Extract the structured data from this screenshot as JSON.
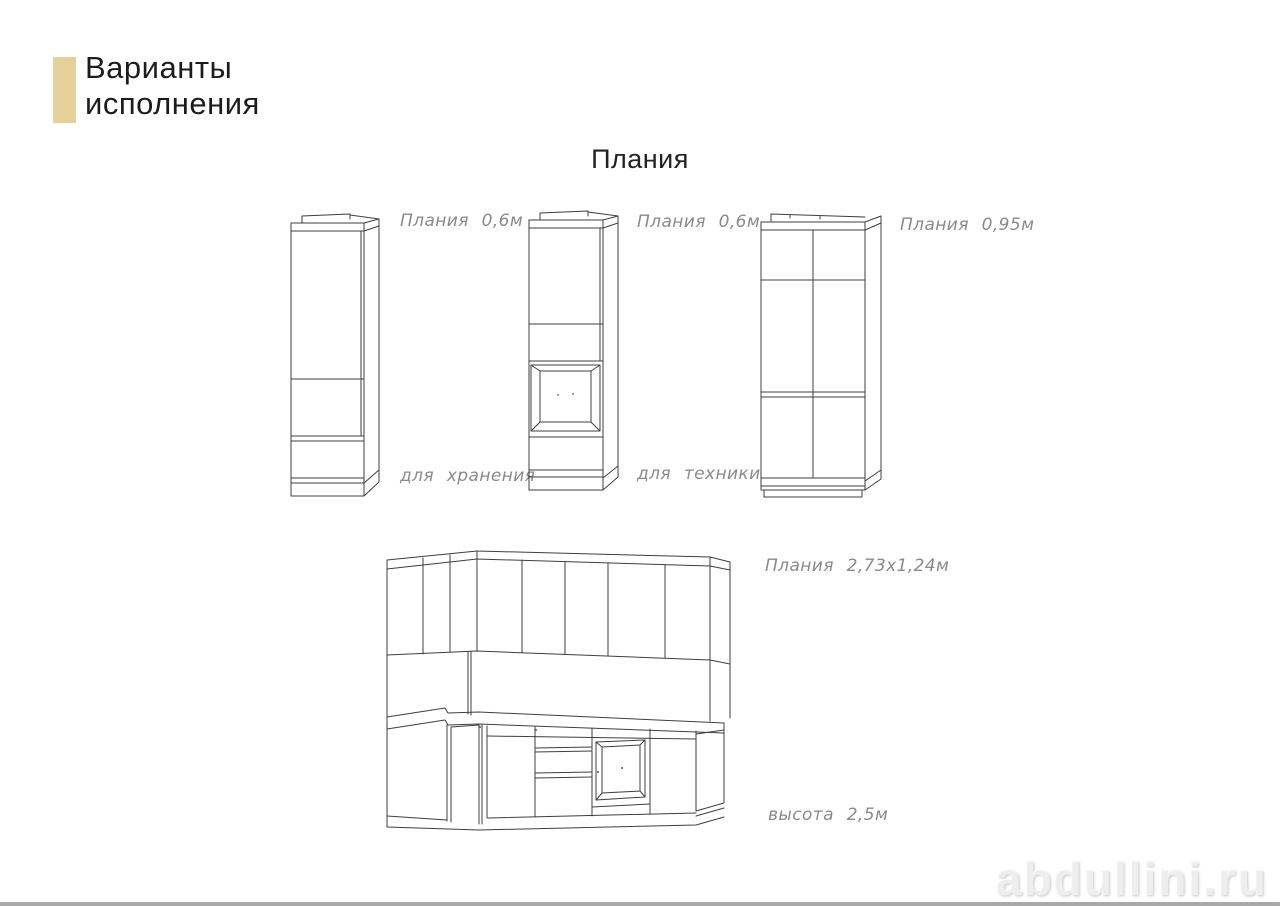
{
  "colors": {
    "accent_bar": "#e5d29a",
    "drawing_line": "#3f3f3f",
    "label_text": "#8a8a8a",
    "watermark": "#eeeeee",
    "bottom_bar": "#a9a9a9"
  },
  "header": {
    "title_line1": "Варианты",
    "title_line2": "исполнения"
  },
  "page_title": "Плания",
  "figures": {
    "cabinet_storage": {
      "size_label": "Плания 0,6м",
      "purpose_label": "для хранения"
    },
    "cabinet_appliance": {
      "size_label": "Плания 0,6м",
      "purpose_label": "для техники"
    },
    "cabinet_double": {
      "size_label": "Плания 0,95м"
    },
    "kitchen": {
      "size_label": "Плания 2,73х1,24м",
      "height_label": "высота 2,5м"
    }
  },
  "watermark": "abdullini.ru"
}
